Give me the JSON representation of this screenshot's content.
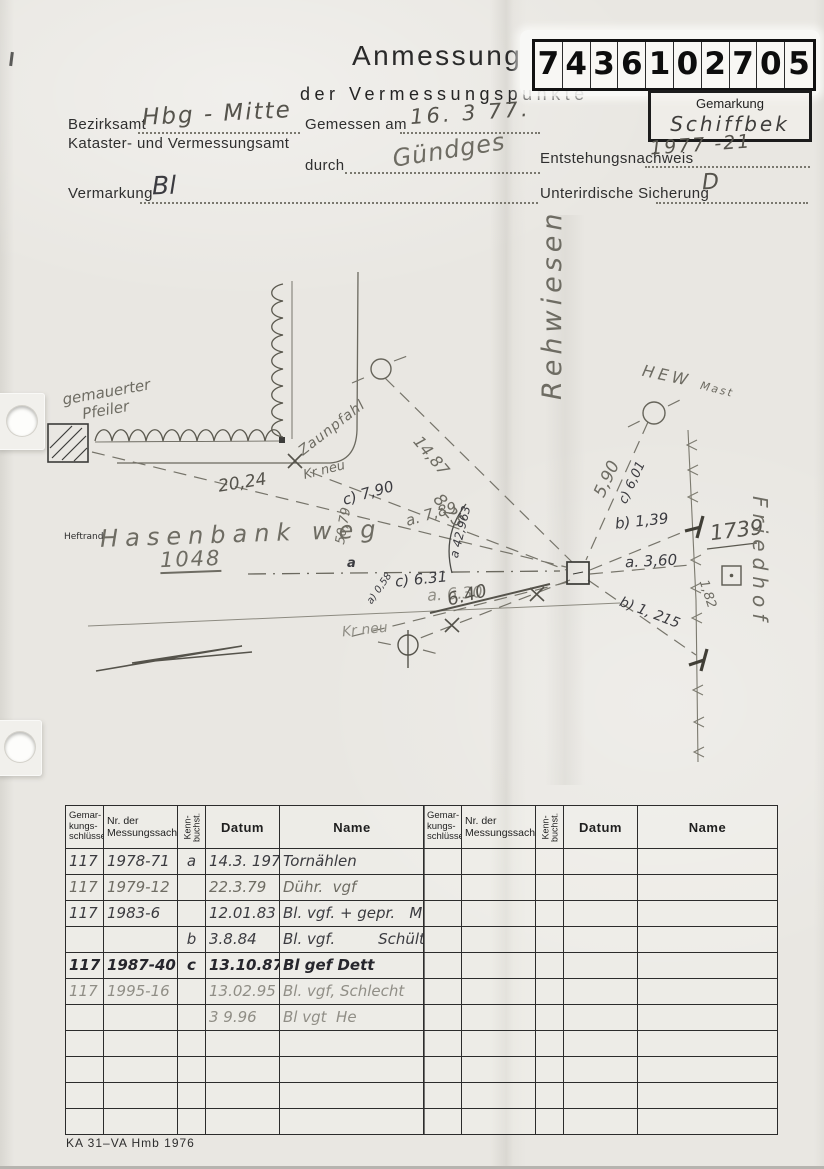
{
  "header": {
    "title_line1": "Anmessung",
    "title_line2": "der Vermessungspunkte",
    "number_digits": [
      "7",
      "4",
      "3",
      "6",
      "1",
      "0",
      "2",
      "7",
      "0",
      "5"
    ],
    "gemarkung_label": "Gemarkung",
    "gemarkung_value": "Schiffbek"
  },
  "form": {
    "bezirksamt_label": "Bezirksamt",
    "bezirksamt_value": "Hbg - Mitte",
    "kataster_label": "Kataster- und Vermessungsamt",
    "gemessen_label": "Gemessen am",
    "gemessen_value": "16. 3 77.",
    "durch_label": "durch",
    "durch_value": "Gündges",
    "entstehung_label": "Entstehungsnachweis",
    "entstehung_value": "1977 -21",
    "vermarkung_label": "Vermarkung",
    "vermarkung_value": "Bl",
    "sicherung_label": "Unterirdische Sicherung",
    "sicherung_value": "D"
  },
  "sketch": {
    "labels": {
      "gemauerter": "gemauerter",
      "pfeiler": "Pfeiler",
      "heftrand": "Heftrand",
      "zaunpfahl": "Zaunpfahl",
      "m2024": "20,24",
      "krneu_top": "Kr neu",
      "c790": "c) 7,90",
      "a789": "a. 7,89",
      "m1487": "14,87",
      "m825": "8,25",
      "a42963": "a 42,963",
      "m5079": "50,79",
      "hasenbank": "Hasenbank weg",
      "n1048": "1048",
      "c631": "c) 6.31",
      "a630": "a. 6.30",
      "m640": "6.40",
      "krneu_bottom": "Kr neu",
      "a058": "a) 0,58",
      "rehwiesen": "Rehwiesen",
      "hew": "HEW",
      "mast": "Mast",
      "m590": "5,90",
      "c601": "c) 6,01",
      "b139": "b) 1,39",
      "a360": "a. 3,60",
      "b1215": "b) 1, 215",
      "m182": "1,82",
      "n1739": "1739",
      "friedhof": "Friedhof",
      "amark": "a"
    }
  },
  "tables": {
    "headers": {
      "col1_l1": "Gemar-",
      "col1_l2": "kungs-",
      "col1_l3": "schlüssel",
      "col2_l1": "Nr. der",
      "col2_l2": "Messungssache",
      "col3_l1": "Kenn-",
      "col3_l2": "buchst.",
      "col4": "Datum",
      "col5": "Name"
    },
    "left_rows": [
      {
        "schluessel": "117",
        "sache": "1978-71",
        "kenn": "a",
        "datum": "14.3. 1978",
        "name": "Tornählen",
        "tone": "ink"
      },
      {
        "schluessel": "117",
        "sache": "1979-12",
        "kenn": "",
        "datum": "22.3.79",
        "name": "Dühr.  vgf",
        "tone": "pencil"
      },
      {
        "schluessel": "117",
        "sache": "1983-6",
        "kenn": "",
        "datum": "12.01.83",
        "name": "Bl. vgf. + gepr.   Ma",
        "tone": "ink"
      },
      {
        "schluessel": "",
        "sache": "",
        "kenn": "b",
        "datum": "3.8.84",
        "name": "Bl. vgf.         Schültke",
        "tone": "ink"
      },
      {
        "schluessel": "117",
        "sache": "1987-40",
        "kenn": "c",
        "datum": "13.10.87",
        "name": "Bl gef Dett",
        "tone": "dark"
      },
      {
        "schluessel": "117",
        "sache": "1995-16",
        "kenn": "",
        "datum": "13.02.95",
        "name": "Bl. vgf, Schlecht",
        "tone": "faint"
      },
      {
        "schluessel": "",
        "sache": "",
        "kenn": "",
        "datum": "3 9.96",
        "name": "Bl vgt  He",
        "tone": "faint"
      }
    ],
    "right_rows": [],
    "total_rows": 11
  },
  "footer": {
    "form_code": "KA 31–VA Hmb 1976"
  }
}
